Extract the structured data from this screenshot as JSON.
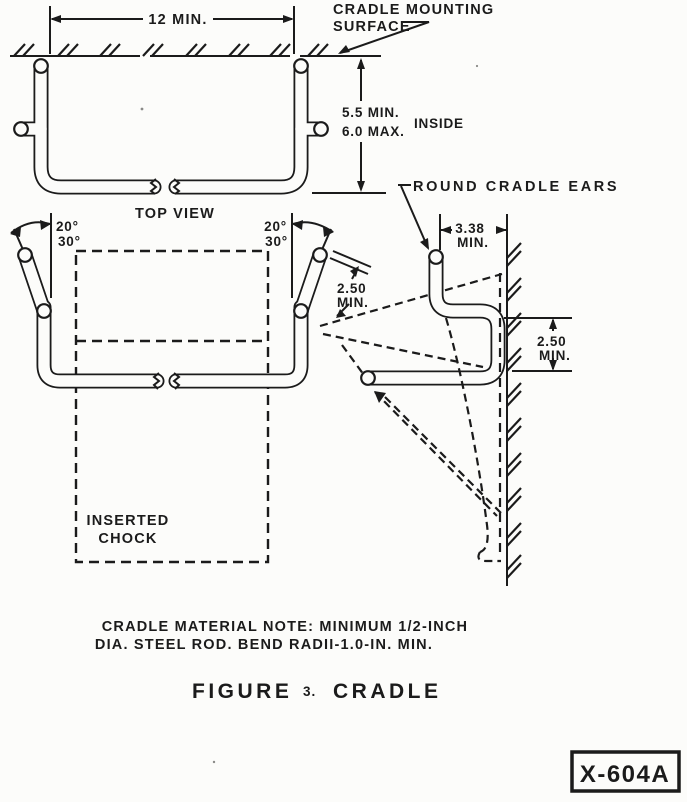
{
  "document": {
    "id_box": "X-604A",
    "figure": {
      "label": "FIGURE",
      "number": "3.",
      "title": "CRADLE"
    },
    "notes": [
      "CRADLE MATERIAL NOTE: MINIMUM 1/2-INCH",
      "DIA. STEEL ROD. BEND RADII-1.0-IN. MIN."
    ]
  },
  "top_view": {
    "title": "TOP VIEW",
    "mounting_label": [
      "CRADLE MOUNTING",
      "SURFACE"
    ],
    "width_dim": "12 MIN.",
    "depth_dim": {
      "line1": "5.5 MIN.",
      "line2": "6.0 MAX.",
      "suffix": "INSIDE"
    }
  },
  "front_view": {
    "angle_upper": "20°",
    "angle_lower": "30°",
    "ear_length_dim": {
      "value": "2.50",
      "qualifier": "MIN."
    },
    "chock_label": [
      "INSERTED",
      "CHOCK"
    ]
  },
  "side_view": {
    "ears_label": "ROUND CRADLE EARS",
    "ear_offset_dim": {
      "value": "3.38",
      "qualifier": "MIN."
    },
    "depth_dim": {
      "value": "2.50",
      "qualifier": "MIN."
    }
  },
  "colors": {
    "ink": "#1b1b1b",
    "paper": "#fcfcfa"
  }
}
